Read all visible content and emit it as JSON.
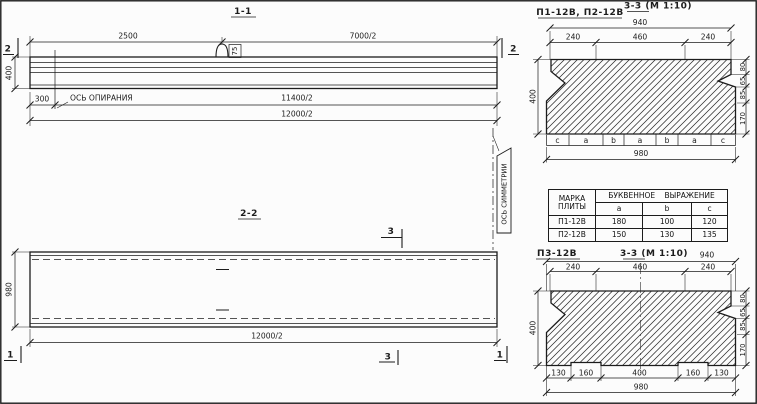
{
  "section11": {
    "title": "1-1",
    "marker": "2",
    "dim_top_left": "2500",
    "dim_top_right": "7000/2",
    "height": "400",
    "loop_width": "75",
    "offset": "300",
    "support_axis_label": "ОСЬ ОПИРАНИЯ",
    "dim_half_support": "11400/2",
    "dim_total": "12000/2"
  },
  "section22": {
    "title": "2-2",
    "marker_cut3": "3",
    "marker_cut1": "1",
    "height": "980",
    "dim_total": "12000/2"
  },
  "symmetry_axis_label": "ОСЬ СИММЕТРИИ",
  "section33_top": {
    "plate_marks": "П1-12В, П2-12В",
    "title": "3-3 (М 1:10)",
    "dim_overall_top": "940",
    "dim_left": "240",
    "dim_mid": "460",
    "dim_right": "240",
    "height": "400",
    "right_dims": [
      "80",
      "65",
      "85",
      "170"
    ],
    "letters": [
      "c",
      "a",
      "b",
      "a",
      "b",
      "a",
      "c"
    ],
    "dim_overall_bottom": "980"
  },
  "letter_table": {
    "header_col1_line1": "МАРКА",
    "header_col1_line2": "ПЛИТЫ",
    "header_group": "БУКВЕННОЕ ВЫРАЖЕНИЕ",
    "col_a": "a",
    "col_b": "b",
    "col_c": "c",
    "rows": [
      {
        "mark": "П1-12В",
        "a": "180",
        "b": "100",
        "c": "120"
      },
      {
        "mark": "П2-12В",
        "a": "150",
        "b": "130",
        "c": "135"
      }
    ]
  },
  "section33_bottom": {
    "plate_mark": "П3-12В",
    "title": "3-3 (М 1:10)",
    "dim_overall_top": "940",
    "dim_left": "240",
    "dim_mid": "460",
    "dim_right": "240",
    "height": "400",
    "right_dims": [
      "80",
      "65",
      "85",
      "170"
    ],
    "bottom_dims": [
      "130",
      "160",
      "400",
      "160",
      "130"
    ],
    "dim_overall_bottom": "980"
  }
}
